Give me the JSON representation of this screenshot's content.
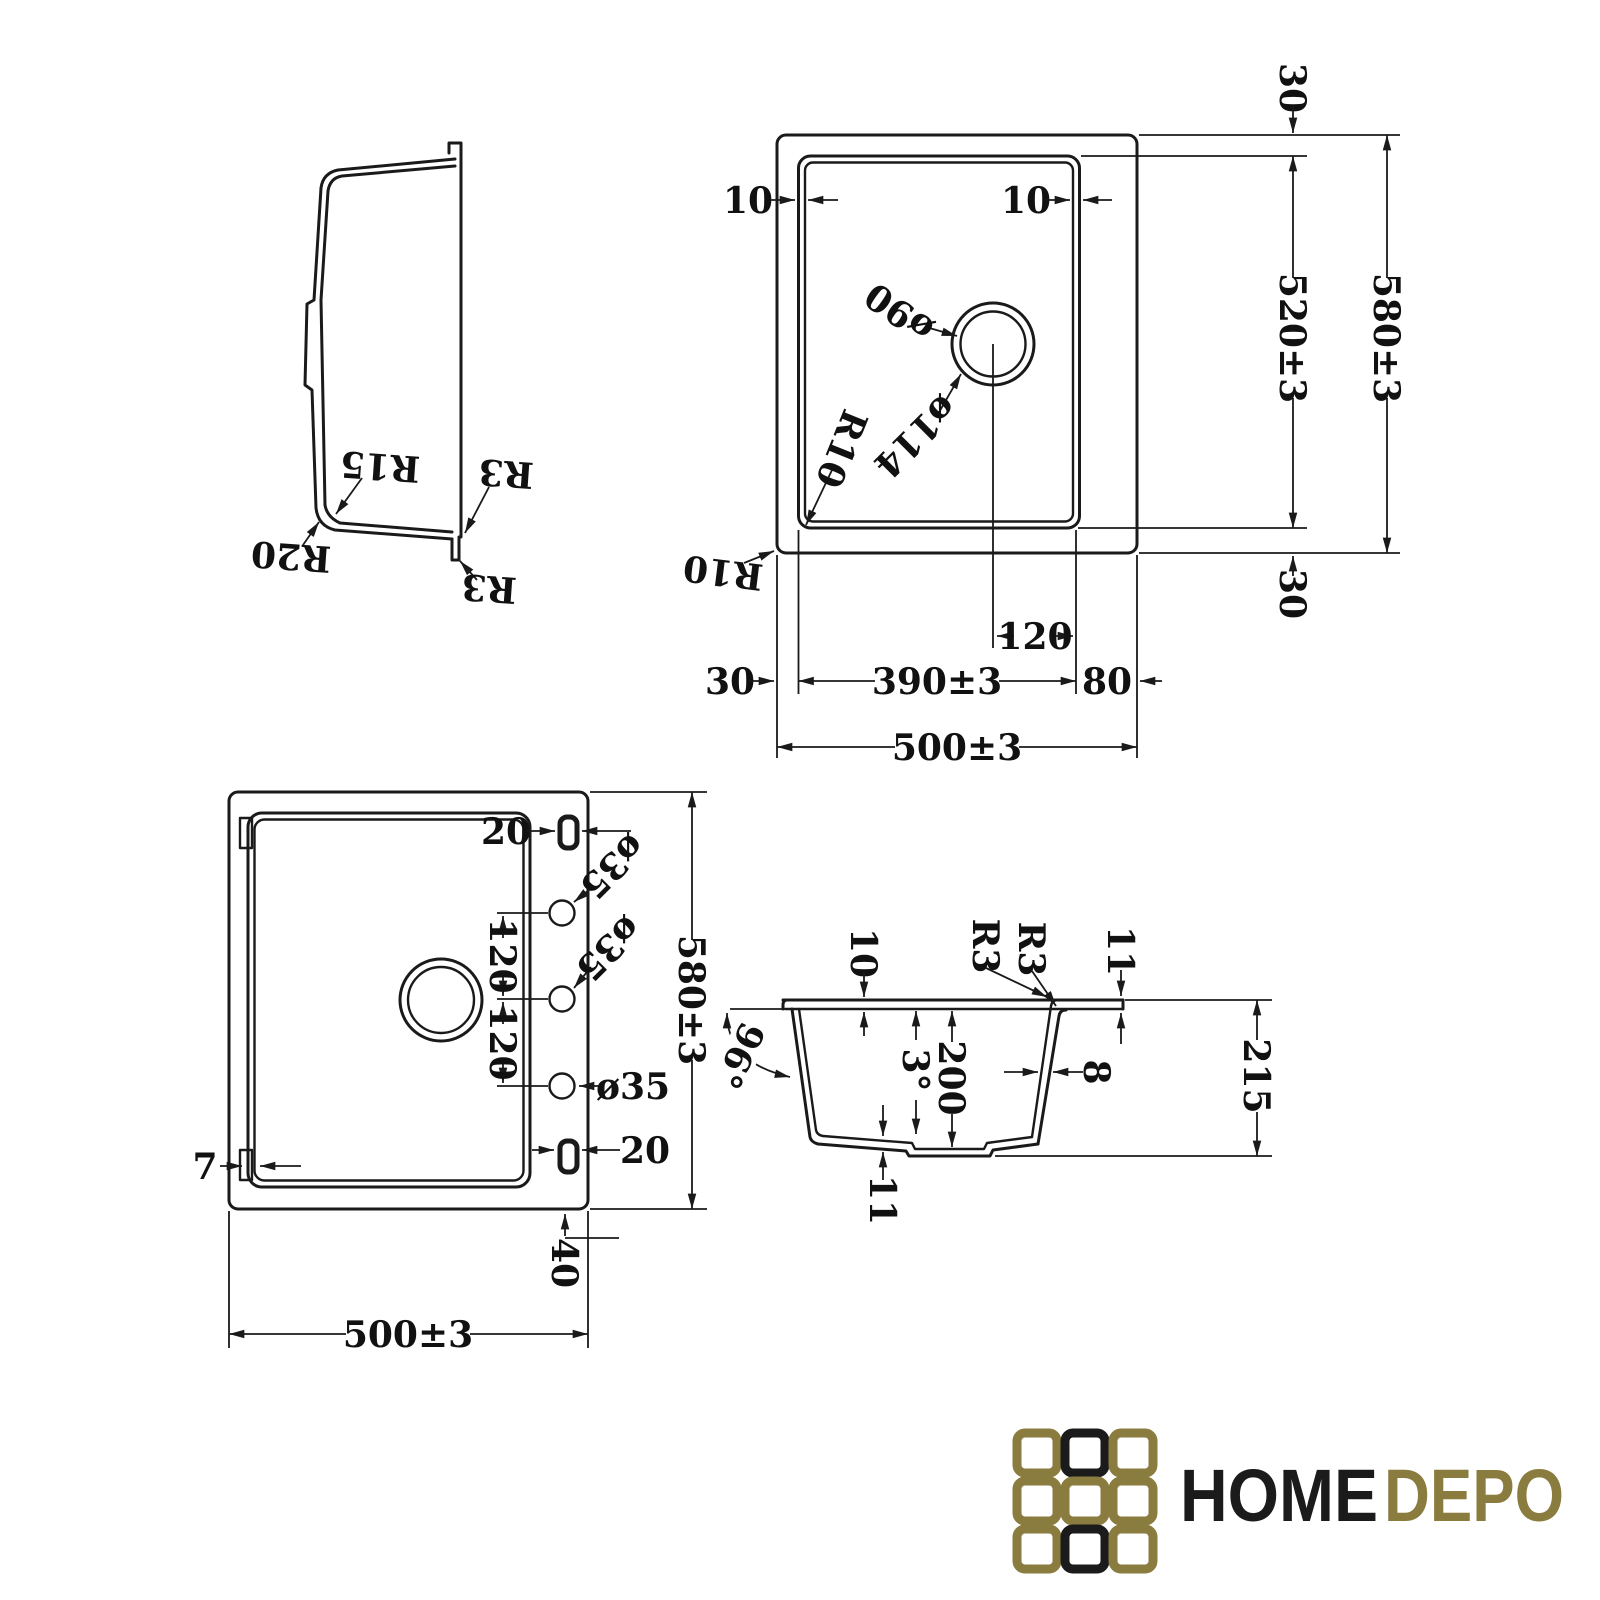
{
  "views": {
    "side_profile": {
      "labels": {
        "r15": "R15",
        "r20": "R20",
        "r3_edge": "R3",
        "r3_lip": "R3"
      }
    },
    "top_view": {
      "labels": {
        "rim_left": "10",
        "rim_right": "10",
        "drain_hole": "ø90",
        "drain_flange": "ø114",
        "bowl_corner_radius": "R10",
        "outer_corner_radius": "R10",
        "margin_top": "30",
        "bowl_depth": "520±3",
        "overall_depth": "580±3",
        "margin_bottom": "30",
        "drain_offset": "120",
        "margin_left": "30",
        "bowl_width": "390±3",
        "margin_right": "80",
        "overall_width": "500±3"
      }
    },
    "bottom_view": {
      "labels": {
        "clip_slot_top": "20",
        "clip_slot_bottom": "20",
        "tap_hole_1": "ø35",
        "tap_hole_2": "ø35",
        "tap_hole_3": "ø35",
        "hole_spacing_1": "120",
        "hole_spacing_2": "120",
        "rim_width": "7",
        "overall_depth": "580±3",
        "base_offset": "40",
        "overall_width": "500±3"
      }
    },
    "section_view": {
      "labels": {
        "rim_height": "10",
        "radius_outer": "R3",
        "radius_inner": "R3",
        "flange_thickness": "11",
        "corner_angle": "96°",
        "draft_angle": "3°",
        "bowl_depth": "200",
        "wall_thickness": "8",
        "overall_height": "215",
        "bottom_thickness": "11"
      }
    }
  },
  "logo": {
    "brand_primary": "HOME",
    "brand_secondary": "DEPO",
    "color_primary": "#1b1b1b",
    "color_secondary": "#8a7b3e",
    "tiles": [
      "gold",
      "black",
      "gold",
      "gold",
      "gold",
      "gold",
      "gold",
      "black",
      "gold"
    ]
  }
}
